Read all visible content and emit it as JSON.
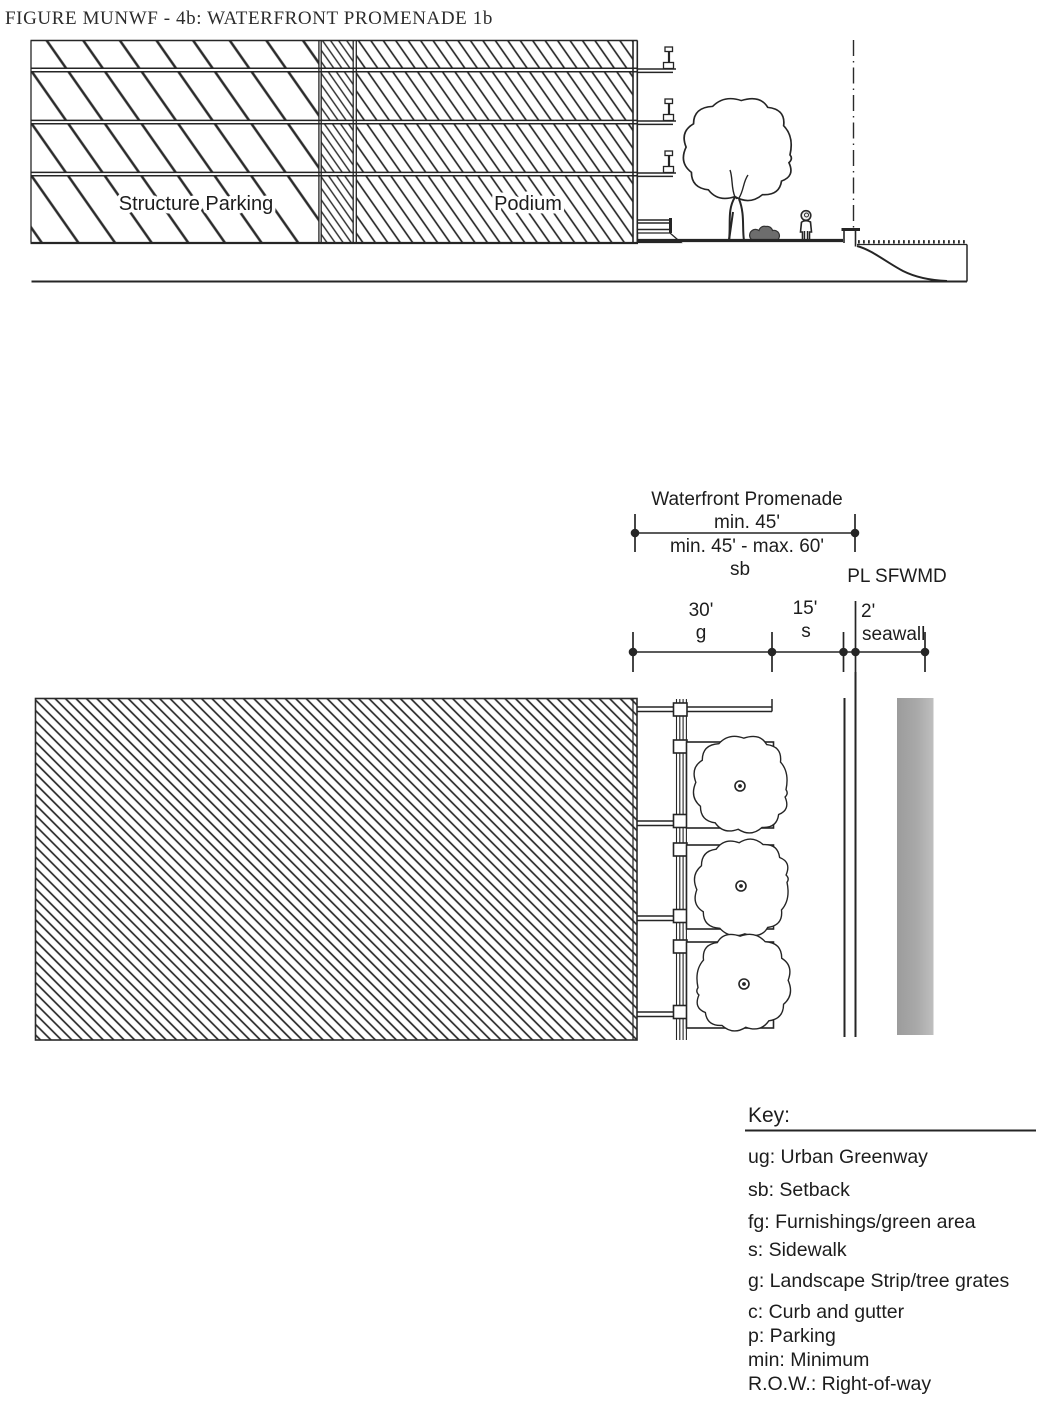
{
  "figure": {
    "title": "FIGURE MUNWF - 4b: WATERFRONT PROMENADE 1b"
  },
  "section": {
    "structure_parking_label": "Structure Parking",
    "podium_label": "Podium"
  },
  "dimensions": {
    "promenade": {
      "title": "Waterfront Promenade",
      "min": "min. 45'",
      "range": "min. 45' - max. 60'",
      "code": "sb"
    },
    "pl_label": "PL SFWMD",
    "segments": {
      "g_value": "30'",
      "g_code": "g",
      "s_value": "15'",
      "s_code": "s",
      "seawall_value": "2'",
      "seawall_code": "seawall"
    }
  },
  "key": {
    "heading": "Key:",
    "entries": [
      "ug: Urban Greenway",
      "sb: Setback",
      "fg: Furnishings/green area",
      "s: Sidewalk",
      "g: Landscape Strip/tree grates",
      "c: Curb and gutter",
      "p: Parking",
      "min: Minimum",
      "R.O.W.: Right-of-way"
    ]
  },
  "colors": {
    "ink": "#252525",
    "water_gray": "#a9a9a9"
  }
}
